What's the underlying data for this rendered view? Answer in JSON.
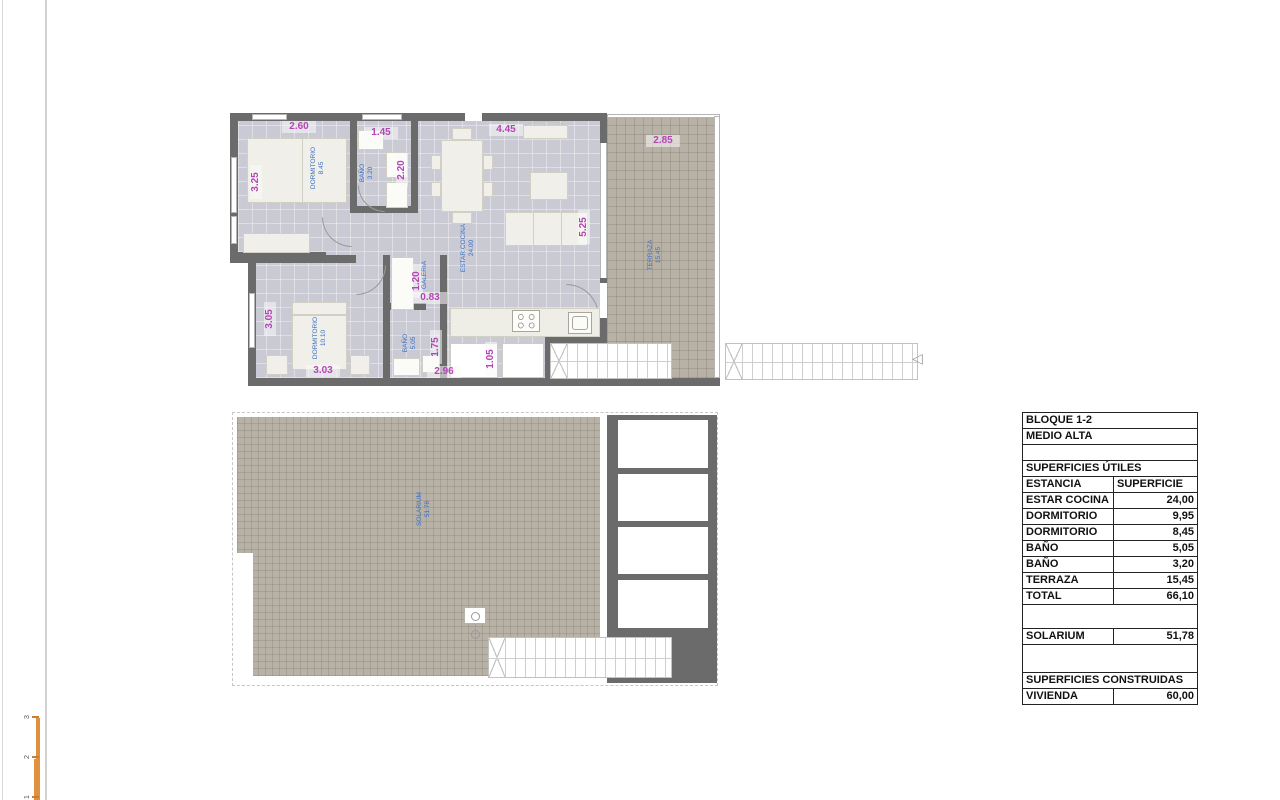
{
  "colors": {
    "wall": "#6b6b6b",
    "interior_floor": "#c9cad3",
    "tile_floor": "#b8b2a6",
    "dimension_text": "#b544b5",
    "room_label_text": "#3b6fc4",
    "scale_bar_orange": "#df913e",
    "table_border": "#222222"
  },
  "floor_plan": {
    "rooms": {
      "dorm1": {
        "name": "DORMITORIO",
        "area": "8.45"
      },
      "bano1": {
        "name": "BAÑO",
        "area": "3.20"
      },
      "estar": {
        "name": "ESTAR COCINA",
        "area": "24.00"
      },
      "terraza": {
        "name": "TERRAZA",
        "area": "15.45"
      },
      "dorm2": {
        "name": "DORMITORIO",
        "area": "10.10"
      },
      "bano2": {
        "name": "BAÑO",
        "area": "5.05"
      },
      "galeria": {
        "name": "GALERIA"
      }
    },
    "dims": {
      "dorm1_w": "2.60",
      "dorm1_h": "3.25",
      "bano1_w": "1.45",
      "bano1_h": "2.20",
      "estar_w": "4.45",
      "estar_h": "5.25",
      "terraza_w": "2.85",
      "galeria_h": "1.20",
      "galeria_w": "0.83",
      "dorm2_h": "3.05",
      "dorm2_w": "3.03",
      "bano2_h": "1.75",
      "bano2_w": "2.96",
      "closet_w": "1.05"
    }
  },
  "solarium_plan": {
    "room": {
      "name": "SOLARIUM",
      "area": "51.78"
    }
  },
  "surface_table": {
    "title1": "BLOQUE 1-2",
    "title2": "MEDIO ALTA",
    "section_utiles": "SUPERFICIES ÚTILES",
    "col_room": "ESTANCIA",
    "col_area": "SUPERFICIE",
    "rows": [
      {
        "name": "ESTAR COCINA",
        "value": "24,00"
      },
      {
        "name": "DORMITORIO",
        "value": "9,95"
      },
      {
        "name": "DORMITORIO",
        "value": "8,45"
      },
      {
        "name": "BAÑO",
        "value": "5,05"
      },
      {
        "name": "BAÑO",
        "value": "3,20"
      },
      {
        "name": "TERRAZA",
        "value": "15,45"
      },
      {
        "name": "TOTAL",
        "value": "66,10"
      }
    ],
    "solarium": {
      "name": "SOLARIUM",
      "value": "51,78"
    },
    "section_construidas": "SUPERFICIES CONSTRUIDAS",
    "vivienda": {
      "name": "VIVIENDA",
      "value": "60,00"
    }
  },
  "scale_bar": {
    "ticks": [
      "3",
      "2",
      "1"
    ]
  }
}
